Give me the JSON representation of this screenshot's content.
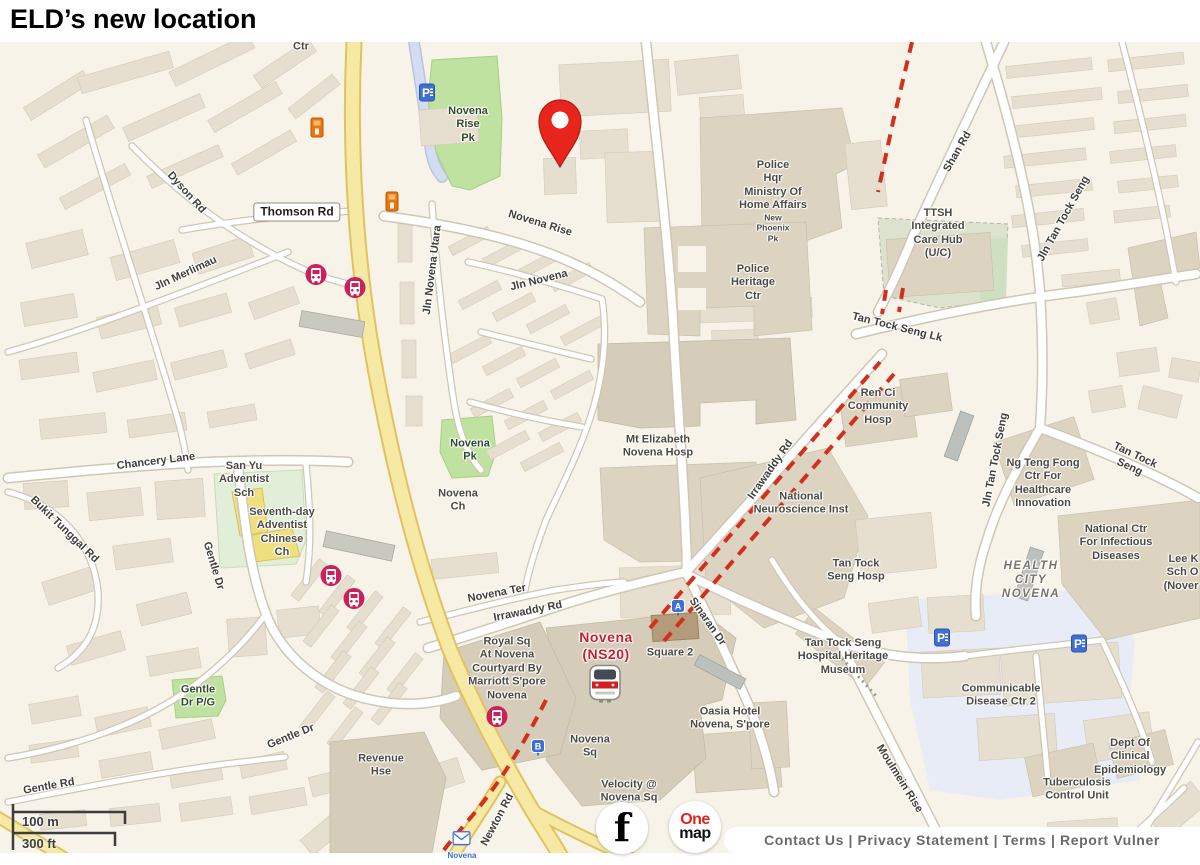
{
  "page_title": "ELD’s new location",
  "footer": {
    "links_text": "Contact Us | Privacy Statement | Terms | Report Vulner"
  },
  "scale_bar": {
    "metric": "100 m",
    "imperial": "300 ft"
  },
  "logos": {
    "facebook_glyph": "f",
    "onemap_top": "One",
    "onemap_bottom": "map"
  },
  "colors": {
    "map_background": "#f8f3e8",
    "park_green": "#bfe2a0",
    "major_road_yellow": "#f6e9a4",
    "construction_dash_red": "#d2301c",
    "marker_red": "#e8251c",
    "station_red": "#c41f2e",
    "parking_blue": "#3e6fd1",
    "bus_pink": "#cb2158",
    "poi_orange": "#e9750f"
  },
  "map": {
    "marker": {
      "name": "location-pin-marker",
      "x": 560,
      "y": 165
    },
    "labels": [
      {
        "n": "label-ctr",
        "t": "Ctr",
        "x": 301,
        "y": 47
      },
      {
        "n": "label-novena-rise-pk",
        "t": "Novena\nRise\nPk",
        "x": 468,
        "y": 125,
        "cls": "park"
      },
      {
        "n": "label-dyson-rd",
        "t": "Dyson Rd",
        "x": 186,
        "y": 193,
        "r": 48,
        "cls": "road"
      },
      {
        "n": "label-thomson-rd",
        "t": "Thomson Rd",
        "x": 297,
        "y": 212,
        "cls": "badge"
      },
      {
        "n": "label-novena-rise-road",
        "t": "Novena  Rise",
        "x": 540,
        "y": 224,
        "r": 17,
        "cls": "road"
      },
      {
        "n": "label-jln-merlimau",
        "t": "Jln Merlimau",
        "x": 186,
        "y": 274,
        "r": -25,
        "cls": "road"
      },
      {
        "n": "label-jln-novena-utara",
        "t": "Jln Novena Utara",
        "x": 433,
        "y": 270,
        "r": -83,
        "cls": "road"
      },
      {
        "n": "label-jln-novena",
        "t": "Jln Novena",
        "x": 539,
        "y": 281,
        "r": -14,
        "cls": "road"
      },
      {
        "n": "label-police-hqr",
        "t": "Police\nHqr\nMinistry Of\nHome Affairs",
        "x": 773,
        "y": 186
      },
      {
        "n": "label-new-phoenix-pk",
        "t": "New\nPhoenix\nPk",
        "x": 773,
        "y": 228,
        "s": 8.5
      },
      {
        "n": "label-police-heritage-ctr",
        "t": "Police\nHeritage\nCtr",
        "x": 753,
        "y": 283
      },
      {
        "n": "label-shan-rd",
        "t": "Shan Rd",
        "x": 958,
        "y": 152,
        "r": -60,
        "cls": "road"
      },
      {
        "n": "label-ttsh-integrated-care-hub",
        "t": "TTSH\nIntegrated\nCare Hub\n(U/C)",
        "x": 938,
        "y": 234
      },
      {
        "n": "label-jln-tan-tock-seng-north",
        "t": "Jln Tan Tock Seng",
        "x": 1064,
        "y": 219,
        "r": -61,
        "cls": "road"
      },
      {
        "n": "label-tan-tock-seng-lk",
        "t": "Tan Tock Seng Lk",
        "x": 897,
        "y": 328,
        "r": 14,
        "cls": "road"
      },
      {
        "n": "label-ren-ci",
        "t": "Ren Ci\nCommunity\nHosp",
        "x": 878,
        "y": 407
      },
      {
        "n": "label-irrawaddy-rd-diag",
        "t": "Irrawaddy Rd",
        "x": 771,
        "y": 470,
        "r": -55,
        "cls": "road"
      },
      {
        "n": "label-jln-tan-tock-seng-mid",
        "t": "Jln Tan Tock Seng",
        "x": 996,
        "y": 460,
        "r": -79,
        "cls": "road"
      },
      {
        "n": "label-mt-elizabeth",
        "t": "Mt Elizabeth\nNovena Hosp",
        "x": 658,
        "y": 447
      },
      {
        "n": "label-novena-pk",
        "t": "Novena\nPk",
        "x": 470,
        "y": 451,
        "cls": "park"
      },
      {
        "n": "label-novena-ch",
        "t": "Novena\nCh",
        "x": 458,
        "y": 501
      },
      {
        "n": "label-national-neuroscience",
        "t": "National\nNeuroscience Inst",
        "x": 801,
        "y": 504
      },
      {
        "n": "label-ng-teng-fong",
        "t": "Ng Teng Fong\nCtr For\nHealthcare\nInnovation",
        "x": 1043,
        "y": 484
      },
      {
        "n": "label-tan-tock-seng-road",
        "t": "Tan Tock Seng",
        "x": 1132,
        "y": 462,
        "r": 25,
        "cls": "road"
      },
      {
        "n": "label-chancery-lane",
        "t": "Chancery Lane",
        "x": 156,
        "y": 462,
        "r": -7,
        "cls": "road"
      },
      {
        "n": "label-san-yu-adventist",
        "t": "San Yu\nAdventist\nSch",
        "x": 244,
        "y": 480
      },
      {
        "n": "label-seventh-day-adventist",
        "t": "Seventh-day\nAdventist\nChinese\nCh",
        "x": 282,
        "y": 533
      },
      {
        "n": "label-bukit-tunggal-rd",
        "t": "Bukit Tunggal Rd",
        "x": 64,
        "y": 530,
        "r": 44,
        "cls": "road"
      },
      {
        "n": "label-gentle-dr-upper",
        "t": "Gentle Dr",
        "x": 213,
        "y": 566,
        "r": 73,
        "cls": "road"
      },
      {
        "n": "label-national-ctr-infectious",
        "t": "National Ctr\nFor Infectious\nDiseases",
        "x": 1116,
        "y": 543
      },
      {
        "n": "label-health-city-novena",
        "t": "HEALTH\nCITY\nNOVENA",
        "x": 1031,
        "y": 580,
        "cls": "area"
      },
      {
        "n": "label-lee-k",
        "t": "Lee K\nSch O\n(Nover",
        "x": 1181,
        "y": 573,
        "cls": "right"
      },
      {
        "n": "label-tan-tock-seng-hosp",
        "t": "Tan Tock\nSeng Hosp",
        "x": 856,
        "y": 571
      },
      {
        "n": "label-novena-ter",
        "t": "Novena Ter",
        "x": 497,
        "y": 594,
        "r": -11,
        "cls": "road"
      },
      {
        "n": "label-irrawaddy-rd-h",
        "t": "Irrawaddy Rd",
        "x": 528,
        "y": 612,
        "r": -11,
        "cls": "road"
      },
      {
        "n": "label-sinaran-dr",
        "t": "Sinaran Dr",
        "x": 707,
        "y": 622,
        "r": 55,
        "cls": "road"
      },
      {
        "n": "label-royal-sq",
        "t": "Royal Sq\nAt Novena\nCourtyard By\nMarriott S'pore\nNovena",
        "x": 507,
        "y": 669
      },
      {
        "n": "label-novena-station",
        "t": "Novena\n(NS20)",
        "x": 606,
        "y": 646,
        "cls": "station"
      },
      {
        "n": "label-square-2",
        "t": "Square 2",
        "x": 670,
        "y": 653
      },
      {
        "n": "label-ttsh-heritage-museum",
        "t": "Tan Tock Seng\nHospital Heritage\nMuseum",
        "x": 843,
        "y": 657
      },
      {
        "n": "label-communicable-disease",
        "t": "Communicable\nDisease Ctr 2",
        "x": 1001,
        "y": 696
      },
      {
        "n": "label-gentle-dr-pg",
        "t": "Gentle\nDr P/G",
        "x": 198,
        "y": 697,
        "cls": "park"
      },
      {
        "n": "label-oasia-hotel",
        "t": "Oasia Hotel\nNovena, S'pore",
        "x": 730,
        "y": 719
      },
      {
        "n": "label-gentle-dr-lower",
        "t": "Gentle Dr",
        "x": 291,
        "y": 737,
        "r": -22,
        "cls": "road"
      },
      {
        "n": "label-novena-sq",
        "t": "Novena\nSq",
        "x": 590,
        "y": 747
      },
      {
        "n": "label-revenue-hse",
        "t": "Revenue\nHse",
        "x": 381,
        "y": 766
      },
      {
        "n": "label-moulmein-rise",
        "t": "Moulmein Rise",
        "x": 899,
        "y": 779,
        "r": 58,
        "cls": "road"
      },
      {
        "n": "label-dept-clinical-epidemiology",
        "t": "Dept Of\nClinical\nEpidemiology",
        "x": 1130,
        "y": 757
      },
      {
        "n": "label-tuberculosis-control",
        "t": "Tuberculosis\nControl Unit",
        "x": 1077,
        "y": 790
      },
      {
        "n": "label-gentle-rd",
        "t": "Gentle Rd",
        "x": 49,
        "y": 787,
        "r": -10,
        "cls": "road"
      },
      {
        "n": "label-velocity",
        "t": "Velocity @\nNovena Sq",
        "x": 629,
        "y": 792
      },
      {
        "n": "label-newton-rd",
        "t": "Newton Rd",
        "x": 498,
        "y": 820,
        "r": -62,
        "cls": "road"
      }
    ],
    "icons": [
      {
        "n": "parking-icon",
        "type": "parking",
        "x": 427,
        "y": 95
      },
      {
        "n": "parking-icon",
        "type": "parking",
        "x": 942,
        "y": 640
      },
      {
        "n": "parking-icon",
        "type": "parking",
        "x": 1079,
        "y": 646
      },
      {
        "n": "bus-stop-icon",
        "type": "bus",
        "x": 316,
        "y": 277
      },
      {
        "n": "bus-stop-icon",
        "type": "bus",
        "x": 355,
        "y": 290
      },
      {
        "n": "bus-stop-icon",
        "type": "bus",
        "x": 331,
        "y": 578
      },
      {
        "n": "bus-stop-icon",
        "type": "bus",
        "x": 354,
        "y": 601
      },
      {
        "n": "bus-stop-icon",
        "type": "bus",
        "x": 497,
        "y": 719
      },
      {
        "n": "building-poi-icon",
        "type": "orange",
        "x": 317,
        "y": 130
      },
      {
        "n": "building-poi-icon",
        "type": "orange",
        "x": 392,
        "y": 204
      },
      {
        "n": "station-exit-a-icon",
        "type": "exit",
        "label": "A",
        "x": 678,
        "y": 610
      },
      {
        "n": "station-exit-b-icon",
        "type": "exit",
        "label": "B",
        "x": 538,
        "y": 750
      },
      {
        "n": "mrt-station-icon",
        "type": "mrt",
        "x": 605,
        "y": 686
      },
      {
        "n": "post-office-icon",
        "type": "post",
        "label": "Novena",
        "x": 462,
        "y": 846
      }
    ]
  }
}
